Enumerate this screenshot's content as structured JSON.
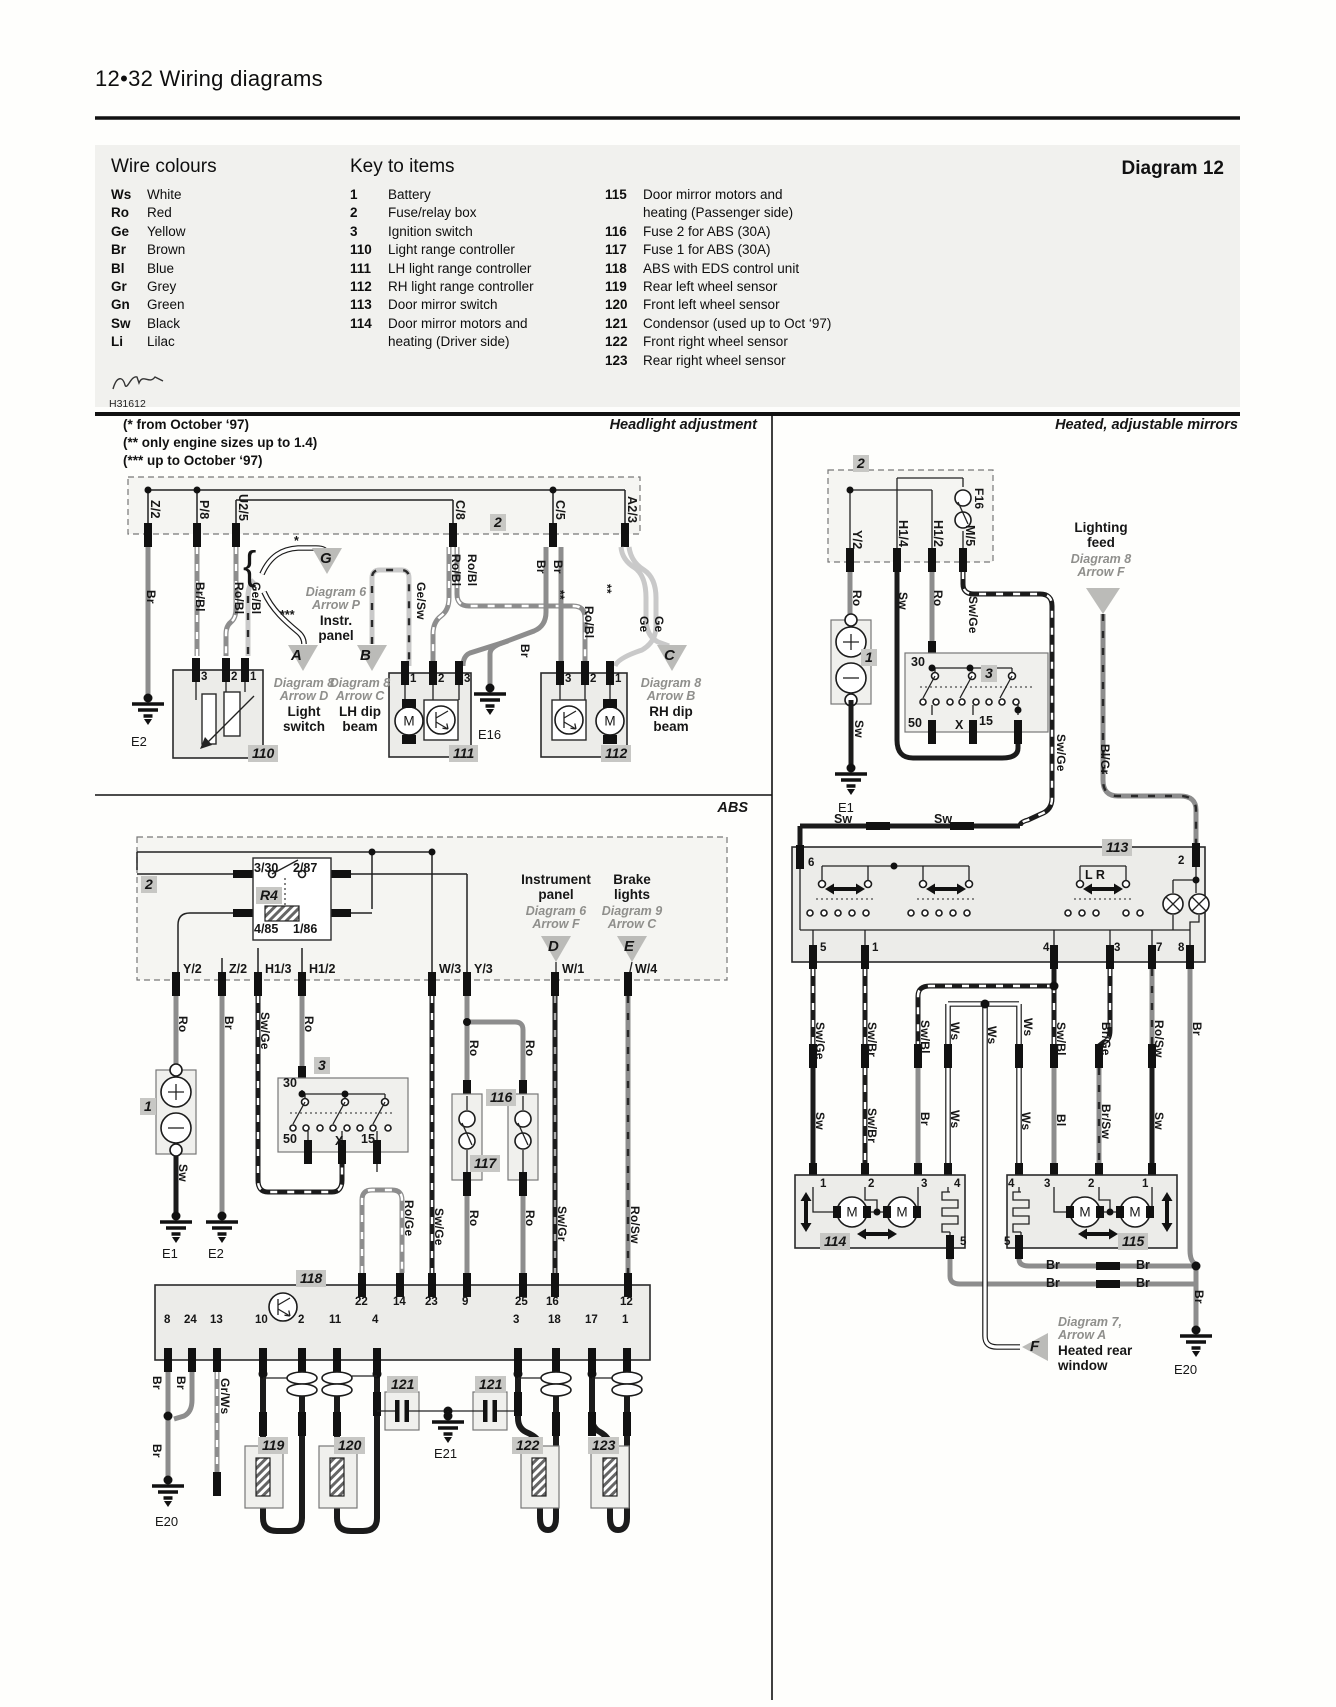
{
  "page": {
    "header": "12•32  Wiring diagrams",
    "diagram_title": "Diagram 12",
    "ref_code": "H31612"
  },
  "wire_colours": {
    "title": "Wire colours",
    "items": [
      {
        "code": "Ws",
        "name": "White"
      },
      {
        "code": "Ro",
        "name": "Red"
      },
      {
        "code": "Ge",
        "name": "Yellow"
      },
      {
        "code": "Br",
        "name": "Brown"
      },
      {
        "code": "Bl",
        "name": "Blue"
      },
      {
        "code": "Gr",
        "name": "Grey"
      },
      {
        "code": "Gn",
        "name": "Green"
      },
      {
        "code": "Sw",
        "name": "Black"
      },
      {
        "code": "Li",
        "name": "Lilac"
      }
    ]
  },
  "key_to_items": {
    "title": "Key to items",
    "left": [
      {
        "num": "1",
        "desc": "Battery"
      },
      {
        "num": "2",
        "desc": "Fuse/relay box"
      },
      {
        "num": "3",
        "desc": "Ignition switch"
      },
      {
        "num": "110",
        "desc": "Light range controller"
      },
      {
        "num": "111",
        "desc": "LH light range controller"
      },
      {
        "num": "112",
        "desc": "RH light range controller"
      },
      {
        "num": "113",
        "desc": "Door mirror switch"
      },
      {
        "num": "114",
        "desc": "Door mirror motors and",
        "desc2": "heating (Driver side)"
      }
    ],
    "right": [
      {
        "num": "115",
        "desc": "Door mirror motors and",
        "desc2": "heating (Passenger side)"
      },
      {
        "num": "116",
        "desc": "Fuse 2 for ABS (30A)"
      },
      {
        "num": "117",
        "desc": "Fuse 1 for ABS (30A)"
      },
      {
        "num": "118",
        "desc": "ABS with EDS control unit"
      },
      {
        "num": "119",
        "desc": "Rear left wheel sensor"
      },
      {
        "num": "120",
        "desc": "Front left wheel sensor"
      },
      {
        "num": "121",
        "desc": "Condensor (used up to Oct ‘97)"
      },
      {
        "num": "122",
        "desc": "Front right wheel sensor"
      },
      {
        "num": "123",
        "desc": "Rear right wheel sensor"
      }
    ]
  },
  "notes": [
    "(*  from October ‘97)",
    "(** only engine sizes up to 1.4)",
    "(***  up to October ‘97)"
  ],
  "diagram_labels": [
    [
      "Headlight adjustment",
      757,
      417,
      "s"
    ],
    [
      "Z/2",
      162,
      500,
      "c"
    ],
    [
      "P/8",
      211,
      500,
      "c"
    ],
    [
      "U2/5",
      250,
      494,
      "c"
    ],
    [
      "C/8",
      467,
      500,
      "c"
    ],
    [
      "C/5",
      567,
      500,
      "c"
    ],
    [
      "A2/3",
      639,
      496,
      "c"
    ],
    [
      "2",
      490,
      514,
      "t"
    ],
    [
      "Br",
      158,
      590,
      "w"
    ],
    [
      "Br/Bl",
      207,
      582,
      "w"
    ],
    [
      "Ro/Bl",
      246,
      582,
      "w"
    ],
    [
      "Ge/Bl",
      263,
      582,
      "w"
    ],
    [
      "{",
      243,
      544,
      "brc"
    ],
    [
      "*",
      294,
      534,
      "x"
    ],
    [
      "***",
      280,
      608,
      "x"
    ],
    [
      "Ge/Sw",
      428,
      582,
      "w"
    ],
    [
      "Ro/Bl",
      463,
      554,
      "w"
    ],
    [
      "Ro/Bl",
      479,
      554,
      "w"
    ],
    [
      "Br",
      548,
      560,
      "w"
    ],
    [
      "Br",
      565,
      560,
      "w"
    ],
    [
      "**",
      567,
      590,
      "w"
    ],
    [
      "Ro/Bl",
      596,
      606,
      "w"
    ],
    [
      "**",
      614,
      584,
      "w"
    ],
    [
      "Ge",
      651,
      616,
      "w"
    ],
    [
      "Ge",
      666,
      616,
      "w"
    ],
    [
      "Br",
      532,
      644,
      "w"
    ],
    [
      "G",
      320,
      550,
      "a"
    ],
    [
      "A",
      291,
      647,
      "a"
    ],
    [
      "B",
      360,
      647,
      "a"
    ],
    [
      "C",
      664,
      647,
      "a"
    ],
    [
      "Diagram 6",
      336,
      585,
      "i"
    ],
    [
      "Arrow P",
      336,
      598,
      "i"
    ],
    [
      "Instr.",
      336,
      613,
      "d"
    ],
    [
      "panel",
      336,
      628,
      "d"
    ],
    [
      "Diagram 8",
      304,
      676,
      "i"
    ],
    [
      "Arrow D",
      304,
      689,
      "i"
    ],
    [
      "Light",
      304,
      704,
      "d"
    ],
    [
      "switch",
      304,
      719,
      "d"
    ],
    [
      "Diagram 8",
      360,
      676,
      "i"
    ],
    [
      "Arrow C",
      360,
      689,
      "i"
    ],
    [
      "LH dip",
      360,
      704,
      "d"
    ],
    [
      "beam",
      360,
      719,
      "d"
    ],
    [
      "Diagram 8",
      671,
      676,
      "i"
    ],
    [
      "Arrow B",
      671,
      689,
      "i"
    ],
    [
      "RH dip",
      671,
      704,
      "d"
    ],
    [
      "beam",
      671,
      719,
      "d"
    ],
    [
      "3",
      201,
      671,
      "p"
    ],
    [
      "2",
      231,
      671,
      "p"
    ],
    [
      "1",
      250,
      671,
      "p"
    ],
    [
      "1",
      410,
      673,
      "p"
    ],
    [
      "2",
      438,
      673,
      "p"
    ],
    [
      "3",
      464,
      673,
      "p"
    ],
    [
      "3",
      565,
      673,
      "p"
    ],
    [
      "2",
      590,
      673,
      "p"
    ],
    [
      "1",
      615,
      673,
      "p"
    ],
    [
      "110",
      248,
      745,
      "t"
    ],
    [
      "111",
      449,
      745,
      "t"
    ],
    [
      "112",
      601,
      745,
      "t"
    ],
    [
      "E2",
      131,
      734,
      "g"
    ],
    [
      "E16",
      478,
      727,
      "g"
    ],
    [
      "M",
      409,
      721,
      "m"
    ],
    [
      "M",
      610,
      721,
      "m"
    ],
    [
      "ABS",
      748,
      800,
      "s"
    ],
    [
      "2",
      141,
      876,
      "t"
    ],
    [
      "3/30",
      254,
      861,
      "x"
    ],
    [
      "2/87",
      293,
      861,
      "x"
    ],
    [
      "R4",
      256,
      887,
      "t"
    ],
    [
      "4/85",
      254,
      922,
      "x"
    ],
    [
      "1/86",
      293,
      922,
      "x"
    ],
    [
      "Instrument",
      556,
      872,
      "d"
    ],
    [
      "panel",
      556,
      887,
      "d"
    ],
    [
      "Diagram 6",
      556,
      904,
      "i"
    ],
    [
      "Arrow F",
      556,
      917,
      "i"
    ],
    [
      "D",
      548,
      938,
      "a"
    ],
    [
      "Brake",
      632,
      872,
      "d"
    ],
    [
      "lights",
      632,
      887,
      "d"
    ],
    [
      "Diagram 9",
      632,
      904,
      "i"
    ],
    [
      "Arrow C",
      632,
      917,
      "i"
    ],
    [
      "E",
      624,
      938,
      "a"
    ],
    [
      "Y/2",
      183,
      962,
      "x"
    ],
    [
      "Z/2",
      229,
      962,
      "x"
    ],
    [
      "H1/3",
      265,
      962,
      "x"
    ],
    [
      "H1/2",
      309,
      962,
      "x"
    ],
    [
      "W/3",
      439,
      962,
      "x"
    ],
    [
      "Y/3",
      474,
      962,
      "x"
    ],
    [
      "W/1",
      562,
      962,
      "x"
    ],
    [
      "W/4",
      635,
      962,
      "x"
    ],
    [
      "Ro",
      190,
      1016,
      "w"
    ],
    [
      "Br",
      236,
      1016,
      "w"
    ],
    [
      "Sw/Ge",
      272,
      1012,
      "w"
    ],
    [
      "Ro",
      316,
      1016,
      "w"
    ],
    [
      "Ro",
      481,
      1040,
      "w"
    ],
    [
      "Ro",
      537,
      1040,
      "w"
    ],
    [
      "1",
      140,
      1098,
      "t"
    ],
    [
      "30",
      283,
      1076,
      "x"
    ],
    [
      "3",
      314,
      1057,
      "t"
    ],
    [
      "50",
      283,
      1132,
      "x"
    ],
    [
      "X",
      335,
      1134,
      "x"
    ],
    [
      "15",
      361,
      1132,
      "x"
    ],
    [
      "116",
      486,
      1089,
      "t"
    ],
    [
      "117",
      470,
      1155,
      "t"
    ],
    [
      "Sw",
      190,
      1164,
      "w"
    ],
    [
      "E1",
      162,
      1246,
      "g"
    ],
    [
      "E2",
      208,
      1246,
      "g"
    ],
    [
      "Ro/Ge",
      416,
      1200,
      "w"
    ],
    [
      "Sw/Ge",
      446,
      1208,
      "w"
    ],
    [
      "Ro",
      481,
      1210,
      "w"
    ],
    [
      "Ro",
      537,
      1210,
      "w"
    ],
    [
      "Sw/Gr",
      569,
      1206,
      "w"
    ],
    [
      "Ro/Sw",
      642,
      1206,
      "w"
    ],
    [
      "118",
      296,
      1270,
      "t"
    ],
    [
      "22",
      355,
      1296,
      "p"
    ],
    [
      "14",
      393,
      1296,
      "p"
    ],
    [
      "23",
      425,
      1296,
      "p"
    ],
    [
      "9",
      462,
      1296,
      "p"
    ],
    [
      "25",
      515,
      1296,
      "p"
    ],
    [
      "16",
      546,
      1296,
      "p"
    ],
    [
      "12",
      620,
      1296,
      "p"
    ],
    [
      "8",
      164,
      1314,
      "p"
    ],
    [
      "24",
      184,
      1314,
      "p"
    ],
    [
      "13",
      210,
      1314,
      "p"
    ],
    [
      "10",
      255,
      1314,
      "p"
    ],
    [
      "2",
      298,
      1314,
      "p"
    ],
    [
      "11",
      329,
      1314,
      "p"
    ],
    [
      "4",
      372,
      1314,
      "p"
    ],
    [
      "3",
      513,
      1314,
      "p"
    ],
    [
      "18",
      548,
      1314,
      "p"
    ],
    [
      "17",
      585,
      1314,
      "p"
    ],
    [
      "1",
      622,
      1314,
      "p"
    ],
    [
      "Br",
      164,
      1376,
      "w"
    ],
    [
      "Br",
      188,
      1376,
      "w"
    ],
    [
      "Gr/Ws",
      232,
      1378,
      "w"
    ],
    [
      "Br",
      164,
      1444,
      "w"
    ],
    [
      "121",
      387,
      1376,
      "t"
    ],
    [
      "121",
      475,
      1376,
      "t"
    ],
    [
      "119",
      258,
      1437,
      "t"
    ],
    [
      "120",
      334,
      1437,
      "t"
    ],
    [
      "122",
      512,
      1437,
      "t"
    ],
    [
      "123",
      588,
      1437,
      "t"
    ],
    [
      "E21",
      434,
      1446,
      "g"
    ],
    [
      "E20",
      155,
      1514,
      "g"
    ],
    [
      "Heated, adjustable mirrors",
      1238,
      417,
      "s"
    ],
    [
      "2",
      853,
      455,
      "t"
    ],
    [
      "F16",
      986,
      488,
      "w"
    ],
    [
      "Y/2",
      864,
      530,
      "c"
    ],
    [
      "H1/4",
      910,
      520,
      "c"
    ],
    [
      "H1/2",
      945,
      520,
      "c"
    ],
    [
      "M/5",
      977,
      525,
      "c"
    ],
    [
      "Ro",
      864,
      590,
      "w"
    ],
    [
      "Sw",
      910,
      592,
      "w"
    ],
    [
      "Ro",
      945,
      590,
      "w"
    ],
    [
      "Sw/Ge",
      980,
      596,
      "w"
    ],
    [
      "Lighting",
      1101,
      520,
      "d"
    ],
    [
      "feed",
      1101,
      535,
      "d"
    ],
    [
      "Diagram 8",
      1101,
      552,
      "i"
    ],
    [
      "Arrow F",
      1101,
      565,
      "i"
    ],
    [
      "1",
      861,
      649,
      "t"
    ],
    [
      "Sw",
      866,
      720,
      "w"
    ],
    [
      "3",
      981,
      665,
      "t"
    ],
    [
      "30",
      911,
      655,
      "x"
    ],
    [
      "50",
      908,
      716,
      "x"
    ],
    [
      "X",
      955,
      718,
      "x"
    ],
    [
      "15",
      979,
      714,
      "x"
    ],
    [
      "Sw/Ge",
      1068,
      734,
      "w"
    ],
    [
      "Bl/Gr",
      1112,
      744,
      "w"
    ],
    [
      "E1",
      838,
      800,
      "g"
    ],
    [
      "Sw",
      834,
      812,
      "x"
    ],
    [
      "Sw",
      934,
      812,
      "x"
    ],
    [
      "113",
      1102,
      839,
      "t"
    ],
    [
      "6",
      808,
      857,
      "p"
    ],
    [
      "2",
      1178,
      855,
      "p"
    ],
    [
      "L R",
      1085,
      868,
      "x"
    ],
    [
      "5",
      820,
      942,
      "p"
    ],
    [
      "1",
      872,
      942,
      "p"
    ],
    [
      "4",
      1043,
      942,
      "p"
    ],
    [
      "3",
      1114,
      942,
      "p"
    ],
    [
      "7",
      1156,
      942,
      "p"
    ],
    [
      "8",
      1178,
      942,
      "p"
    ],
    [
      "Sw/Ge",
      827,
      1022,
      "w"
    ],
    [
      "Sw/Br",
      879,
      1022,
      "w"
    ],
    [
      "Sw/Bl",
      932,
      1020,
      "w"
    ],
    [
      "Ws",
      962,
      1022,
      "w"
    ],
    [
      "Ws",
      999,
      1026,
      "w"
    ],
    [
      "Ws",
      1035,
      1018,
      "w"
    ],
    [
      "Sw/Bl",
      1068,
      1022,
      "w"
    ],
    [
      "Br/Ge",
      1113,
      1022,
      "w"
    ],
    [
      "Ro/Sw",
      1166,
      1020,
      "w"
    ],
    [
      "Br",
      1204,
      1022,
      "w"
    ],
    [
      "Sw",
      827,
      1112,
      "w"
    ],
    [
      "Sw/Br",
      879,
      1108,
      "w"
    ],
    [
      "Br",
      932,
      1112,
      "w"
    ],
    [
      "Ws",
      962,
      1110,
      "w"
    ],
    [
      "Ws",
      1033,
      1112,
      "w"
    ],
    [
      "Bl",
      1068,
      1114,
      "w"
    ],
    [
      "Br/Sw",
      1113,
      1104,
      "w"
    ],
    [
      "Sw",
      1166,
      1112,
      "w"
    ],
    [
      "1",
      820,
      1178,
      "p"
    ],
    [
      "2",
      868,
      1178,
      "p"
    ],
    [
      "3",
      921,
      1178,
      "p"
    ],
    [
      "4",
      954,
      1178,
      "p"
    ],
    [
      "5",
      960,
      1236,
      "p"
    ],
    [
      "4",
      1008,
      1178,
      "p"
    ],
    [
      "3",
      1044,
      1178,
      "p"
    ],
    [
      "2",
      1088,
      1178,
      "p"
    ],
    [
      "1",
      1142,
      1178,
      "p"
    ],
    [
      "5",
      1004,
      1236,
      "p"
    ],
    [
      "114",
      820,
      1233,
      "t"
    ],
    [
      "115",
      1118,
      1233,
      "t"
    ],
    [
      "M",
      852,
      1212,
      "m"
    ],
    [
      "M",
      902,
      1212,
      "m"
    ],
    [
      "M",
      1085,
      1212,
      "m"
    ],
    [
      "M",
      1135,
      1212,
      "m"
    ],
    [
      "Br",
      1046,
      1258,
      "x"
    ],
    [
      "Br",
      1136,
      1258,
      "x"
    ],
    [
      "Br",
      1046,
      1276,
      "x"
    ],
    [
      "Br",
      1136,
      1276,
      "x"
    ],
    [
      "Br",
      1206,
      1290,
      "w"
    ],
    [
      "F",
      1030,
      1338,
      "a"
    ],
    [
      "Diagram 7,",
      1058,
      1315,
      "il"
    ],
    [
      "Arrow A",
      1058,
      1328,
      "il"
    ],
    [
      "Heated rear",
      1058,
      1343,
      "dl"
    ],
    [
      "window",
      1058,
      1358,
      "dl"
    ],
    [
      "E20",
      1174,
      1362,
      "g"
    ]
  ]
}
